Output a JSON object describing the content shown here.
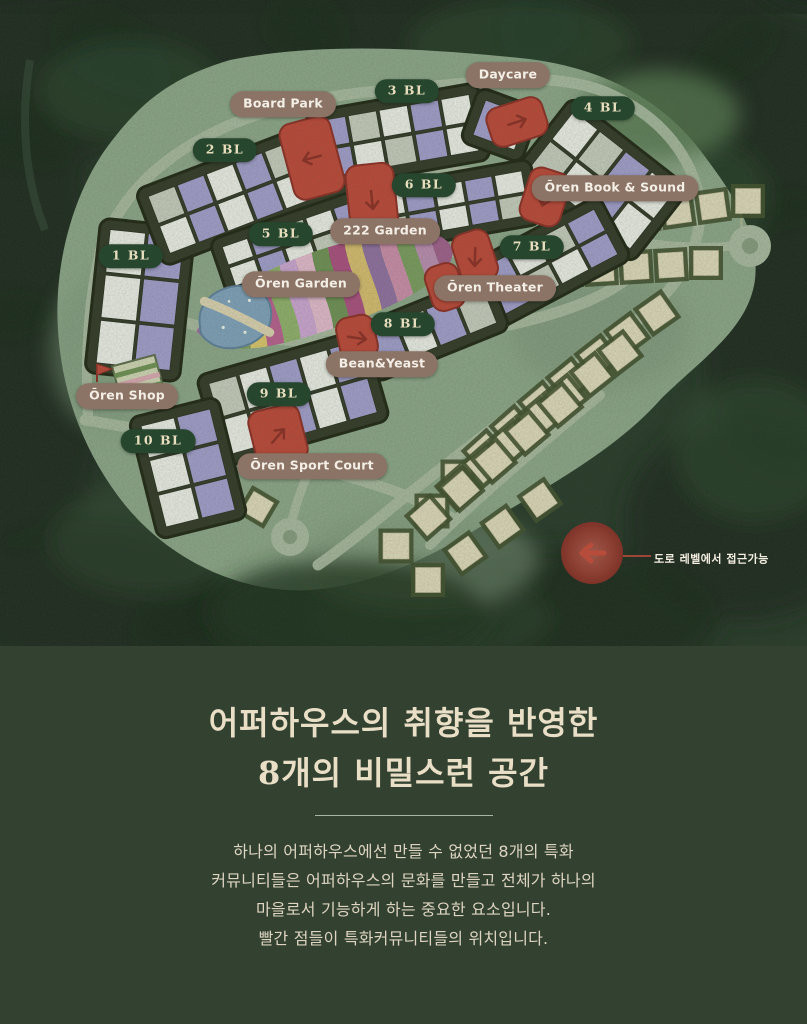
{
  "map": {
    "legend_label": "도로 레벨에서 접근가능",
    "blocks": [
      {
        "label": "1 BL"
      },
      {
        "label": "2 BL"
      },
      {
        "label": "3 BL"
      },
      {
        "label": "4 BL"
      },
      {
        "label": "5 BL"
      },
      {
        "label": "6 BL"
      },
      {
        "label": "7 BL"
      },
      {
        "label": "8 BL"
      },
      {
        "label": "9 BL"
      },
      {
        "label": "10 BL"
      }
    ],
    "amenities": [
      {
        "label": "Board Park"
      },
      {
        "label": "Daycare"
      },
      {
        "label": "Ōren Book & Sound"
      },
      {
        "label": "222 Garden"
      },
      {
        "label": "Ōren Garden"
      },
      {
        "label": "Ōren Theater"
      },
      {
        "label": "Bean&Yeast"
      },
      {
        "label": "Ōren Shop"
      },
      {
        "label": "Ōren Sport Court"
      }
    ]
  },
  "content": {
    "title_line1": "어퍼하우스의 취향을 반영한",
    "title_line2": "8개의 비밀스런 공간",
    "body_lines": [
      "하나의 어퍼하우스에선 만들 수 없었던 8개의 특화",
      "커뮤니티들은 어퍼하우스의 문화를 만들고 전체가 하나의",
      "마을로서 기능하게 하는 중요한 요소입니다.",
      "빨간 점들이 특화커뮤니티들의 위치입니다."
    ]
  },
  "colors": {
    "page_background": "#334130",
    "forest_green": "#243425",
    "site_sage": "#8ca487",
    "road": "#a7b79e",
    "building_lavender": "#a09cc9",
    "building_white": "#e8eae2",
    "marker_red": "#bb4839",
    "pill_green": "#27462e",
    "pill_brown": "#8b7365",
    "lot_beige": "#dcd6b8",
    "title_text": "#e9dec6"
  }
}
